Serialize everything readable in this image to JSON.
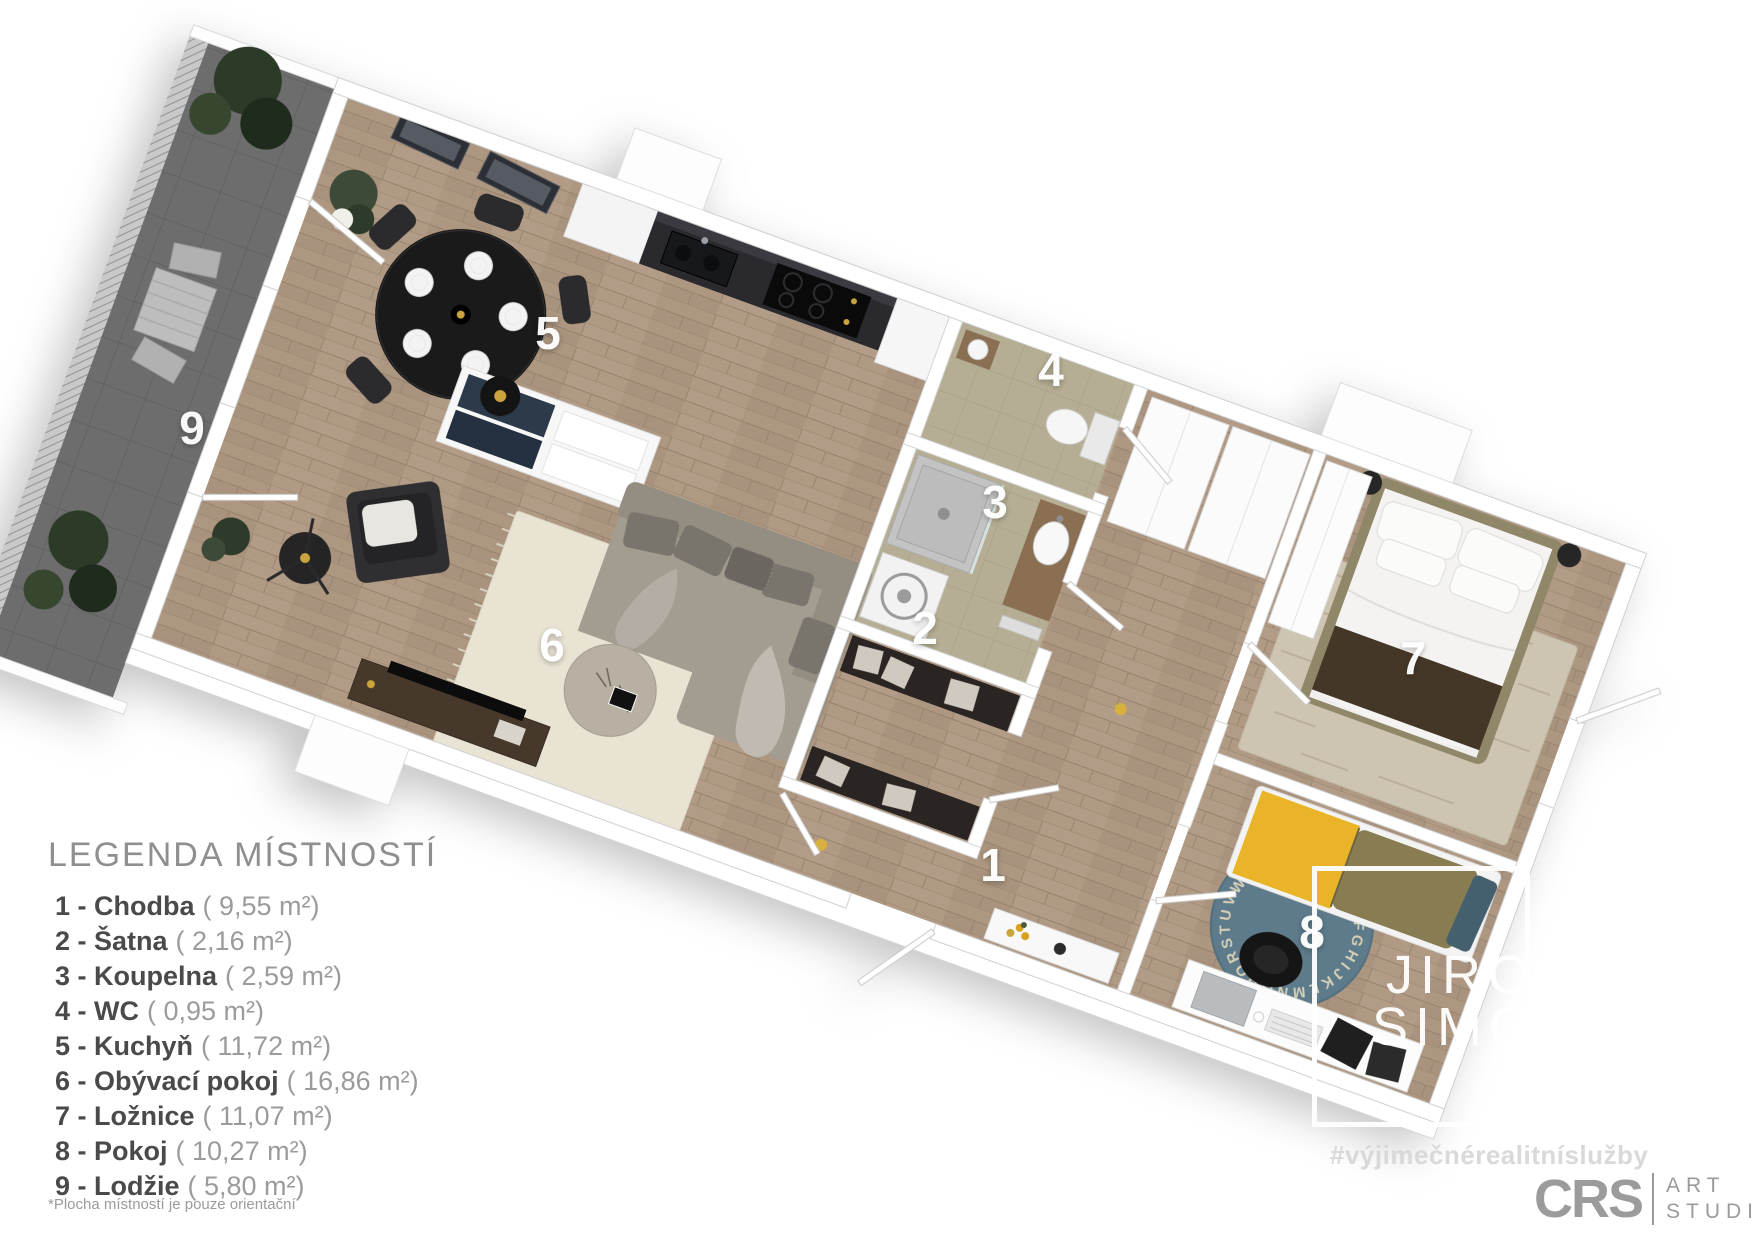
{
  "legend": {
    "title": "LEGENDA MÍSTNOSTÍ",
    "items": [
      {
        "label": "1 - Chodba",
        "area": "( 9,55 m²)"
      },
      {
        "label": "2 - Šatna",
        "area": "( 2,16 m²)"
      },
      {
        "label": "3 - Koupelna",
        "area": "( 2,59 m²)"
      },
      {
        "label": "4 - WC",
        "area": "( 0,95 m²)"
      },
      {
        "label": "5 - Kuchyň",
        "area": "( 11,72 m²)"
      },
      {
        "label": "6 - Obývací pokoj",
        "area": "( 16,86 m²)"
      },
      {
        "label": "7 - Ložnice",
        "area": "( 11,07 m²)"
      },
      {
        "label": "8 - Pokoj",
        "area": "( 10,27 m²)"
      },
      {
        "label": "9 - Lodžie",
        "area": "( 5,80 m²)"
      }
    ],
    "footnote": "*Plocha místností je pouze orientační"
  },
  "plan": {
    "room_labels": [
      {
        "number": "1"
      },
      {
        "number": "2"
      },
      {
        "number": "3"
      },
      {
        "number": "4"
      },
      {
        "number": "5"
      },
      {
        "number": "6"
      },
      {
        "number": "7"
      },
      {
        "number": "8"
      },
      {
        "number": "9"
      }
    ],
    "rug_letters": "ABCDEFGHIJKLMNOPQRSTUVWXYZAB"
  },
  "watermark": {
    "line1": "JIRO",
    "line2": "SIMON",
    "suffix": "CZ",
    "hashtag": "#výjimečnérealitníslužby"
  },
  "studio_logo": {
    "initials": "CRS",
    "word1": "ART",
    "word2": "STUDIO"
  },
  "colors": {
    "wood_floor": "#b09a85",
    "bath_floor": "#b5ae94",
    "balcony_floor": "#6d6d6d",
    "accent_yellow_bed": "#e9b427",
    "teal_rug": "#5d7b8b",
    "legend_text": "#4a4a4a",
    "logo_gray": "#9b9b9b"
  }
}
